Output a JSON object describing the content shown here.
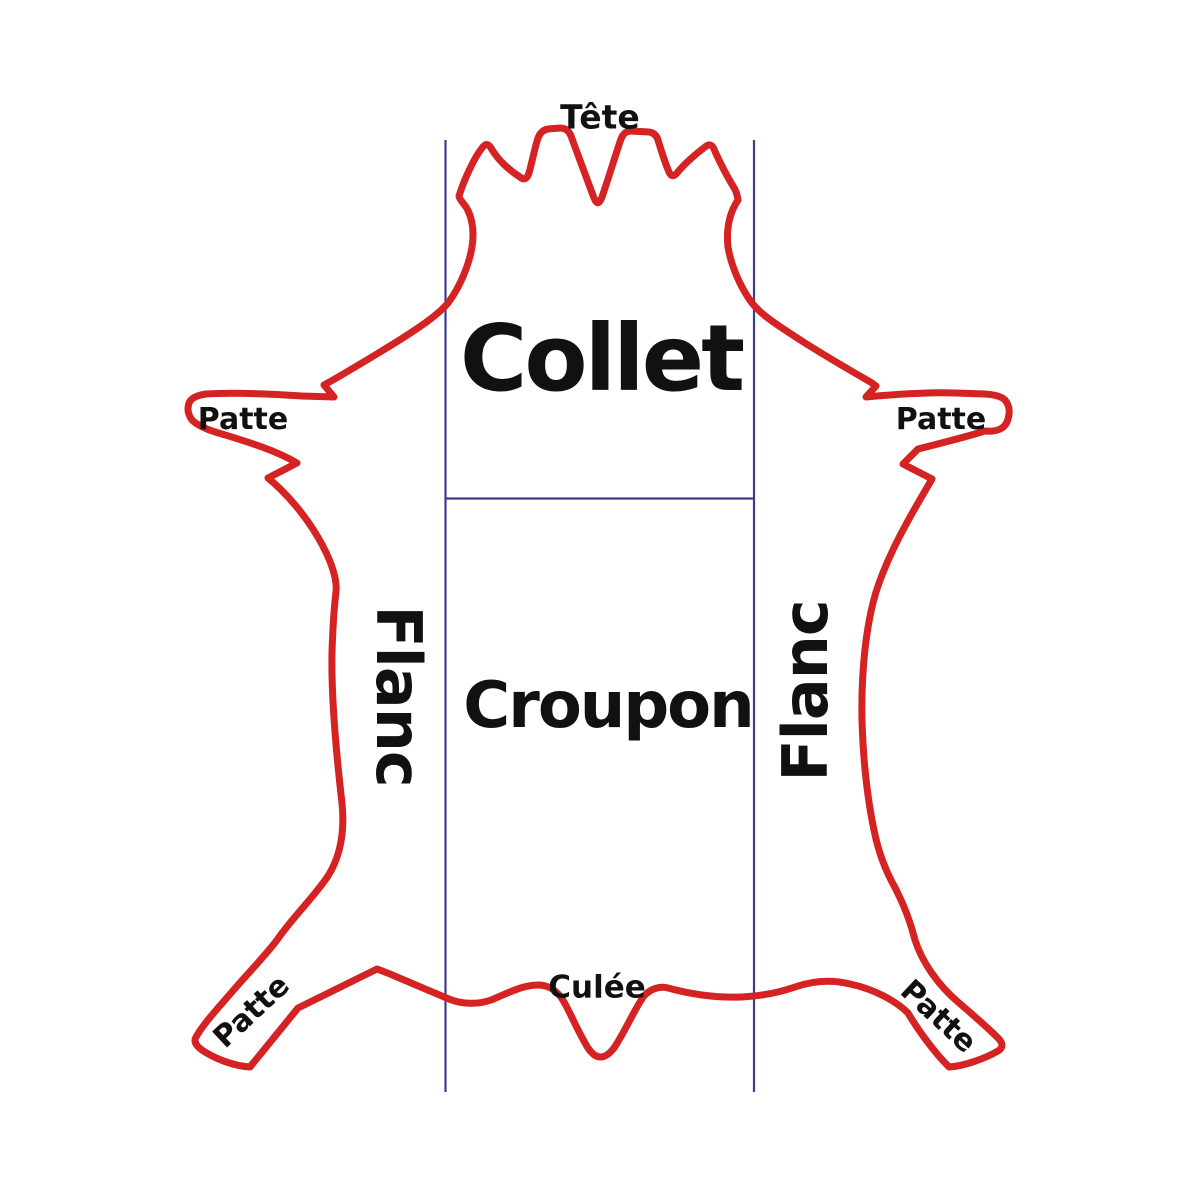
{
  "diagram": {
    "description": "Leather hide cut regions diagram",
    "labels": {
      "tete": "Tête",
      "collet": "Collet",
      "patte_front_left": "Patte",
      "patte_front_right": "Patte",
      "flanc_left": "Flanc",
      "flanc_right": "Flanc",
      "croupon": "Croupon",
      "culee": "Culée",
      "patte_hind_left": "Patte",
      "patte_hind_right": "Patte"
    },
    "colors": {
      "hide_outline": "#d42322",
      "divider_lines": "#3d3d8f",
      "text": "#111111",
      "background": "#ffffff"
    }
  }
}
